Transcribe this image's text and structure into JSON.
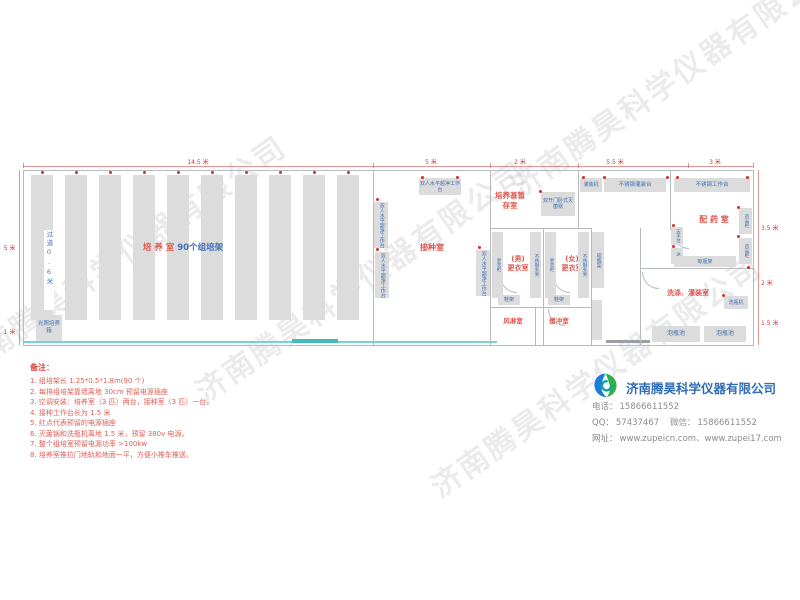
{
  "watermark_text": "济南腾昊科学仪器有限公司",
  "floor_plan": {
    "dims_top": [
      "14.5 米",
      "5 米",
      "2 米",
      "5.5 米",
      "3 米"
    ],
    "dims_right": [
      "3.5 米",
      "2 米",
      "1.5 米"
    ],
    "dims_left": [
      "5 米",
      "1 米"
    ],
    "culture_room": {
      "name": "培 养 室",
      "racks": "90个组培架",
      "aisle": "过道0.6米",
      "light_incubator": "光照培养箱"
    },
    "inoculation_room": {
      "name": "接种室",
      "bench": "双人水平超净工作台"
    },
    "medium_storage": {
      "name": "培养基暂存室",
      "sterilizer": "双开门卧式灭菌锅"
    },
    "changing_area": {
      "male_prefix": "(男)",
      "female_prefix": "(女)",
      "room": "更衣室",
      "locker": "更衣柜",
      "bench": "不锈钢条凳",
      "shoe_rack": "鞋架",
      "bottle_rack": "晾瓶架",
      "air_shower": "风淋室",
      "buffer_room": "缓冲室"
    },
    "pharmacy_room": {
      "name": "配 药 室",
      "filling_machine": "灌装机",
      "filling_table": "不锈钢灌装台",
      "work_table": "不锈钢工作台",
      "balance_table": "天平台",
      "fridge": "冰箱",
      "medicine_cabinet": "药品柜",
      "bottle_rack": "晾瓶架"
    },
    "washing_room": {
      "name": "洗涤、灌装室",
      "bottle_washer": "洗瓶机",
      "soak_pool": "泡瓶池"
    }
  },
  "notes": {
    "title": "备注：",
    "items": [
      "1. 组培架长 1.25*0.5*1.8m(90 个)",
      "2. 每排组培架靠墙离地 30cm 预留电源插座",
      "3. 空调安装：培养室（3 匹）两台，接种室（3 匹）一台。",
      "4. 接种工作台长为 1.5 米",
      "5. 红点代表预留的电源插座",
      "6. 灭菌锅和洗瓶机离地 1.5 米，预留 380v 电源。",
      "7. 整个组培室预留电源功率 >100kw",
      "8. 培养室推拉门地轨和地面一平，方便小推车推送。"
    ]
  },
  "company": {
    "name": "济南腾昊科学仪器有限公司",
    "phone_label": "电话：",
    "phone": "15866611552",
    "qq_label": "QQ：",
    "qq": "57437467",
    "wechat_label": "微信：",
    "wechat": "15866611552",
    "web_label": "网址：",
    "websites": "www.zupeicn.com、www.zupei17.com"
  }
}
